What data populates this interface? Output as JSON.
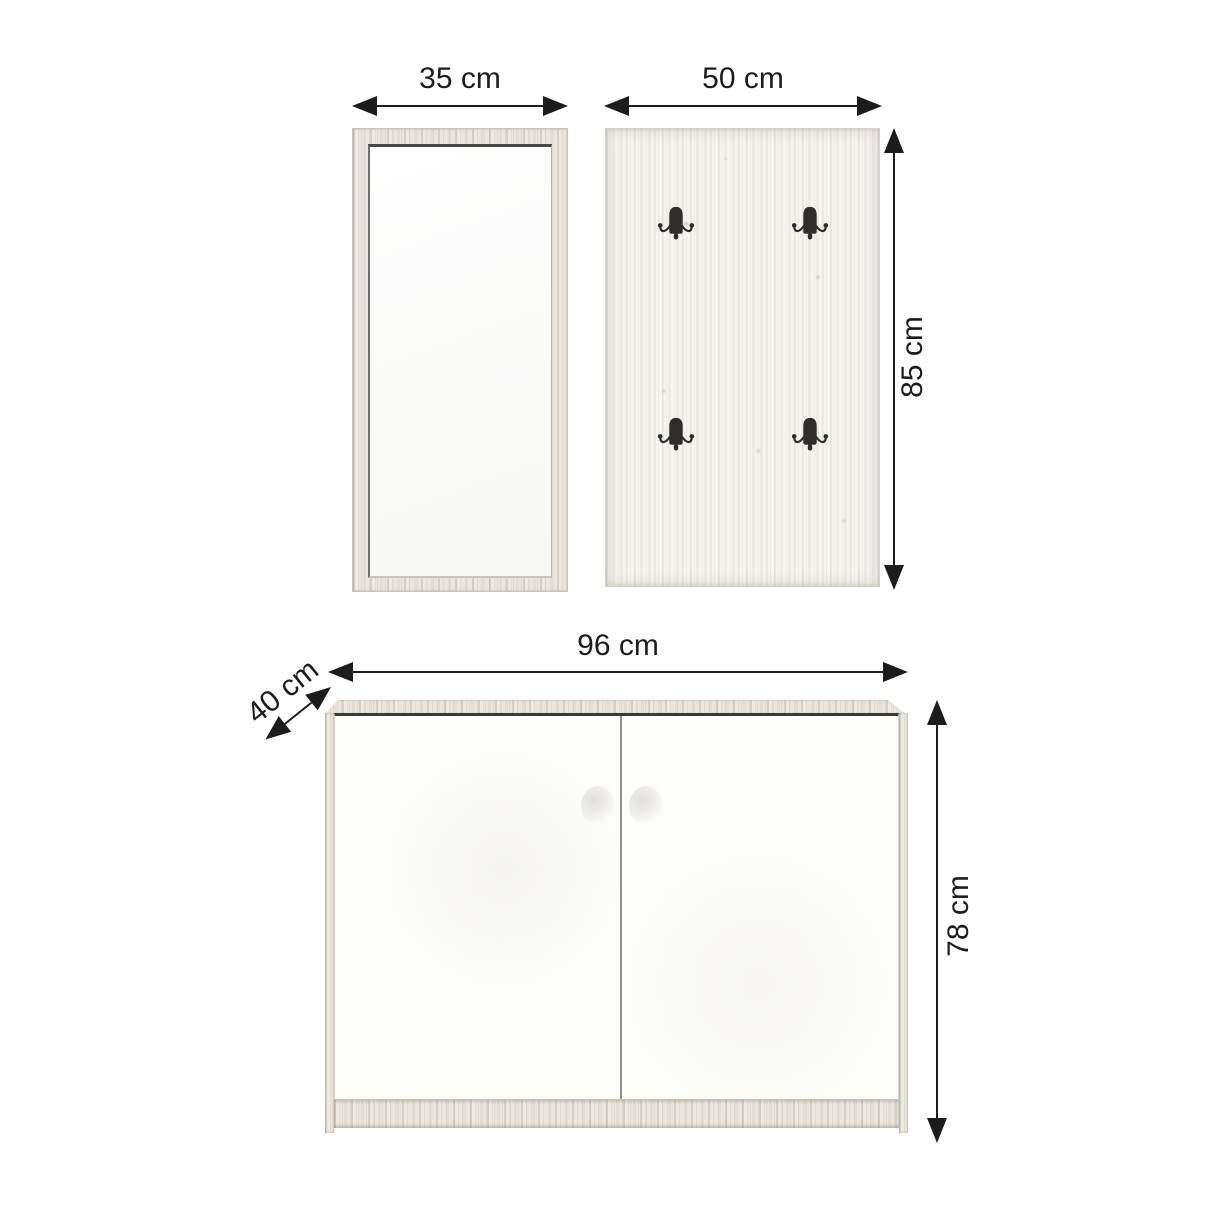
{
  "page": {
    "background_color": "#ffffff",
    "ink_color": "#1c1c1c"
  },
  "dimension_labels": {
    "mirror_width": "35 cm",
    "panel_width": "50 cm",
    "panel_height": "85 cm",
    "cabinet_width": "96 cm",
    "cabinet_depth": "40 cm",
    "cabinet_height": "78 cm"
  },
  "furniture": {
    "mirror": {
      "icon": "wall-mirror"
    },
    "coat_panel": {
      "icon": "coat-hook-panel",
      "hook_count": 4
    },
    "cabinet": {
      "icon": "two-door-cabinet",
      "door_count": 2
    }
  },
  "palette": {
    "wood_light": "#e9e6df",
    "panel_wood": "#f6f4f0",
    "hook_color": "#2f2d2b",
    "mirror_face": "#fbfbfa",
    "door_face": "#fdfdfc"
  }
}
